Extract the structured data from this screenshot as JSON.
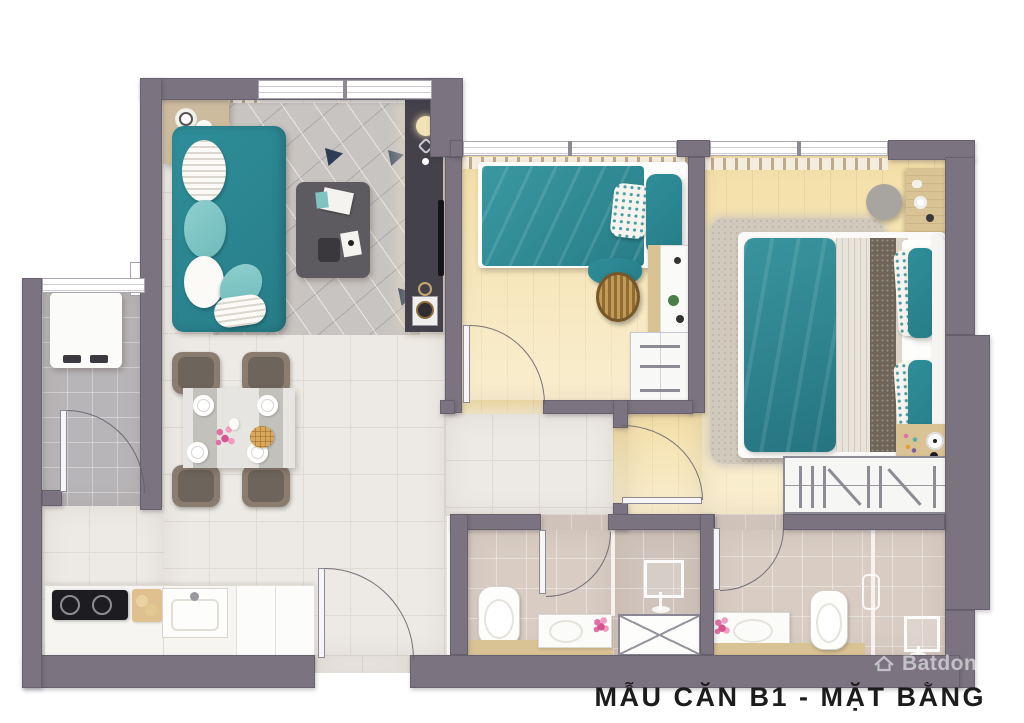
{
  "title": "MẪU CĂN B1 - MẶT BẰNG",
  "watermark": {
    "brand": "Batdongsan",
    "icon": "house-roof-icon"
  },
  "colors": {
    "wall": "#7b7480",
    "tile_floor": "#edeae5",
    "tile_line": "#dfdbd5",
    "wood_floor": "#f4e0a9",
    "bath_floor": "#d8ccc3",
    "shower_floor": "#cfc3bb",
    "balcony_floor": "#b8b5b8",
    "teal": "#2e8e99",
    "rug_living": "#c8c4c1",
    "rug_master": "#d1c9bc",
    "navy": "#2e3c55",
    "console_dark": "#44414a",
    "furniture_wood": "#d9c294",
    "chair": "#8b7c70",
    "chair_seat": "#6d645c",
    "runner_dark": "#6e6457",
    "title_color": "#1c1c1c",
    "watermark_color": "rgba(255,255,255,0.55)"
  },
  "rooms": [
    {
      "id": "living-room",
      "furniture": [
        "sofa",
        "coffee-table",
        "tv-console",
        "geometric-rug",
        "side-table"
      ]
    },
    {
      "id": "dining-area",
      "furniture": [
        "dining-table",
        "four-chairs",
        "plates",
        "flower-centerpiece",
        "waffle-tray"
      ]
    },
    {
      "id": "kitchen",
      "furniture": [
        "counter",
        "induction-cooktop",
        "sink",
        "cutting-board"
      ]
    },
    {
      "id": "loggia-utility",
      "furniture": [
        "washing-machine"
      ]
    },
    {
      "id": "bedroom-1",
      "furniture": [
        "single-bed",
        "laundry-basket",
        "desk",
        "drawer-cabinet"
      ]
    },
    {
      "id": "bedroom-2",
      "furniture": [
        "double-bed",
        "shaggy-rug",
        "pouf",
        "nightstand",
        "wardrobe",
        "bedside-tray"
      ]
    },
    {
      "id": "bathroom-1",
      "furniture": [
        "toilet",
        "vanity-sink",
        "shower-head",
        "service-shaft"
      ]
    },
    {
      "id": "bathroom-2",
      "furniture": [
        "toilet",
        "vanity-sink",
        "shower-glass",
        "shower-head"
      ]
    }
  ]
}
